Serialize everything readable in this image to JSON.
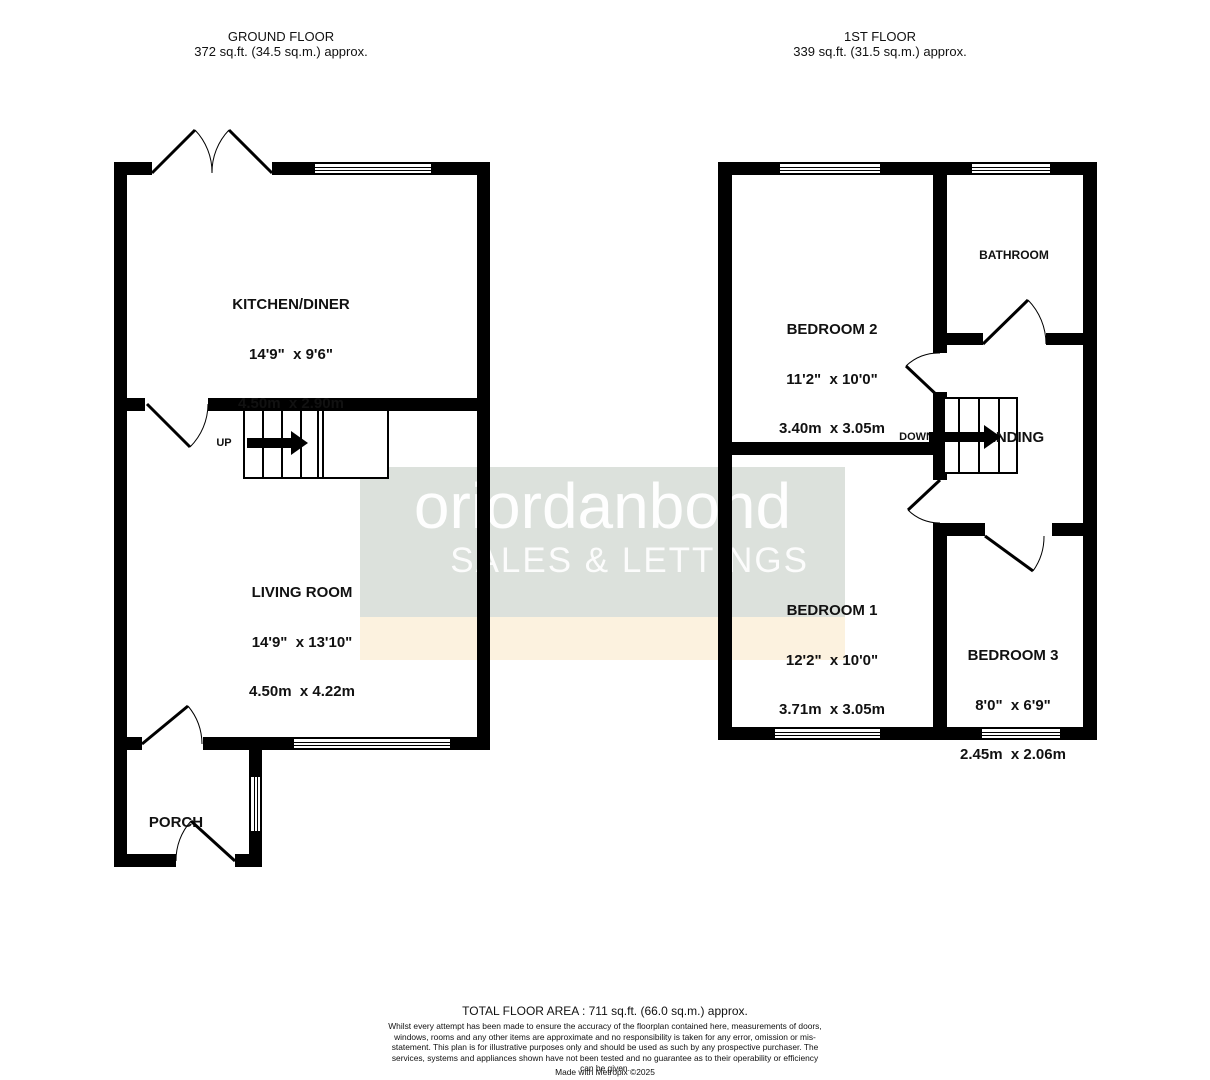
{
  "headers": {
    "ground_floor": {
      "title": "GROUND FLOOR",
      "area": "372 sq.ft. (34.5 sq.m.) approx."
    },
    "first_floor": {
      "title": "1ST FLOOR",
      "area": "339 sq.ft. (31.5 sq.m.) approx."
    }
  },
  "watermark": {
    "brand": "oriordanbond",
    "tagline": "SALES & LETTINGS",
    "panel_color": "#dce1dc",
    "band_color": "#fcf2df",
    "text_color": "#ffffff"
  },
  "rooms": {
    "kitchen_diner": {
      "name": "KITCHEN/DINER",
      "dims_imperial": "14'9\"  x 9'6\"",
      "dims_metric": "4.50m  x 2.90m"
    },
    "living_room": {
      "name": "LIVING ROOM",
      "dims_imperial": "14'9\"  x 13'10\"",
      "dims_metric": "4.50m  x 4.22m"
    },
    "porch": {
      "name": "PORCH"
    },
    "bedroom2": {
      "name": "BEDROOM 2",
      "dims_imperial": "11'2\"  x 10'0\"",
      "dims_metric": "3.40m  x 3.05m"
    },
    "bathroom": {
      "name": "BATHROOM"
    },
    "bedroom1": {
      "name": "BEDROOM 1",
      "dims_imperial": "12'2\"  x 10'0\"",
      "dims_metric": "3.71m  x 3.05m"
    },
    "bedroom3": {
      "name": "BEDROOM 3",
      "dims_imperial": "8'0\"  x 6'9\"",
      "dims_metric": "2.45m  x 2.06m"
    },
    "landing": {
      "name": "LANDING"
    }
  },
  "stairs": {
    "up_label": "UP",
    "down_label": "DOWN"
  },
  "footer": {
    "total_area": "TOTAL FLOOR AREA : 711 sq.ft. (66.0 sq.m.) approx.",
    "disclaimer": "Whilst every attempt has been made to ensure the accuracy of the floorplan contained here, measurements of doors, windows, rooms and any other items are approximate and no responsibility is taken for any error, omission or mis-statement. This plan is for illustrative purposes only and should be used as such by any prospective purchaser. The services, systems and appliances shown have not been tested and no guarantee as to their operability or efficiency can be given.",
    "credit": "Made with Metropix ©2025"
  },
  "colors": {
    "wall": "#000000",
    "background": "#ffffff",
    "text": "#111111"
  }
}
